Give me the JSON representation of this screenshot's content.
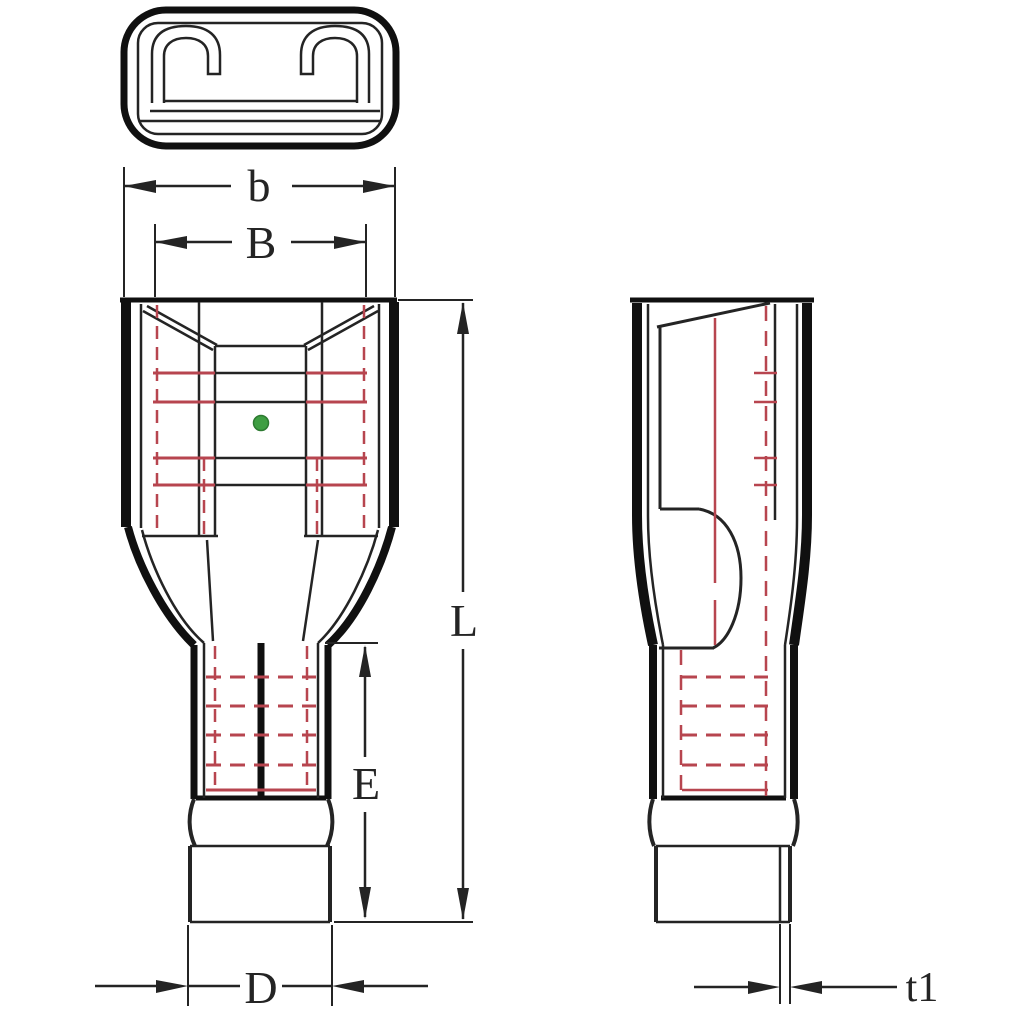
{
  "drawing": {
    "kind": "insulated female quick-disconnect terminal, 3-view technical drawing"
  },
  "dimensions": {
    "b": "b",
    "B": "B",
    "L": "L",
    "E": "E",
    "D": "D",
    "t1": "t1"
  },
  "colors": {
    "line": "#242424",
    "thick": "#101010",
    "hidden_red": "#b7454f",
    "green_dot": "#3e9e42",
    "background": "#ffffff"
  }
}
